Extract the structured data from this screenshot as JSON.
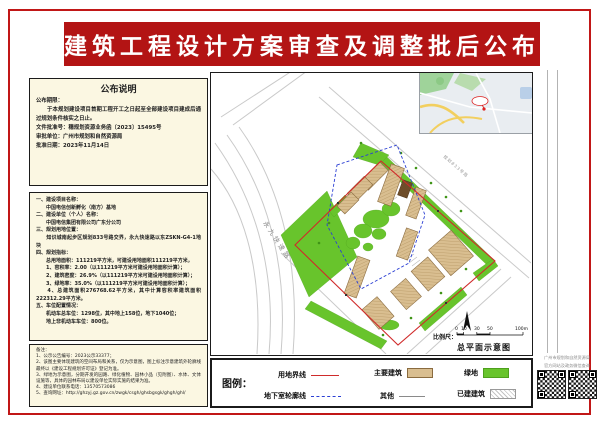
{
  "page": {
    "title": "建筑工程设计方案审查及调整批后公布",
    "colors": {
      "banner_red": "#b31414",
      "frame_red": "#c11717",
      "box_cream": "#fbf7e2",
      "building_tan": "#d9be90",
      "green": "#68c42c",
      "boundary_red": "#cf2b2b",
      "underground_blue": "#2b3fd4",
      "other_gray": "#8a8a8a"
    }
  },
  "announcement": {
    "title": "公布说明",
    "lines": [
      "公布期限：",
      "　　于本规划建设项目首期工程开工之日起至全部建设项目建成后通过规划条件核实之日止。",
      "文件批准号：穗规划资源业务函〔2023〕15495号",
      "审批单位：广州市规划和自然资源局",
      "批准日期：2023年11月14日"
    ]
  },
  "project_info": {
    "lines": [
      "一、建设项目名称：",
      "　　中国电信创新孵化（南方）基地",
      "二、建设单位（个人）名称：",
      "　　中国电信集团有限公司广东分公司",
      "三、规划用地位置：",
      "　　知识城南起步区规划833号路交界，永九快速路以东ZSKN-G4-1地块",
      "四、规划指标：",
      "　　总用地面积：111219平方米，可建设用地面积111219平方米，",
      "　　1、容积率：2.00（以111219平方米可建设用地面积计算）；",
      "　　2、建筑密度：26.9%（以111219平方米可建设用地面积计算）；",
      "　　3、绿地率：35.0%（以111219平方米可建设用地面积计算）；",
      "　　4、总建筑面积276768.62平方米，其中计算容积率建筑面积222312.29平方米。",
      "五、车位配置情况：",
      "　　机动车总车位：1298位，其中地上158位，地下1040位；",
      "　　地上非机动车车位：800位。"
    ]
  },
  "notes": {
    "lines": [
      "备注：",
      "1、公示公告编号：2023公示33377；",
      "2、该图主要体现建筑的空间布局和关系，仅为示意图，图上标注示意建筑外轮廓线最终以《建设工程规划许可证》登记为准。",
      "3、绿地为示意图，分期开发的园路、绿化植物、园林小品（见附图）、水体、文体设施等，具体的园林布局以建设单位实际实施的结果为准。",
      "4、建设单位联系电话：13570573086",
      "5、查询网址：http://ghzyj.gz.gov.cn/zwgk/csgh/ghsbgsgk/ghgh/ghl/"
    ]
  },
  "map": {
    "road_label_west": "永九快速路",
    "road_label_ne": "规划833号路",
    "scale_label": "比例尺：",
    "scale_ticks": [
      "0",
      "10",
      "30",
      "50",
      "100m"
    ],
    "caption": "总平面示意图"
  },
  "legend": {
    "title": "图例：",
    "items": [
      {
        "label": "用地界线",
        "type": "line",
        "color": "#cf2b2b"
      },
      {
        "label": "主要建筑",
        "type": "swatch",
        "color": "#d9be90"
      },
      {
        "label": "绿地",
        "type": "swatch",
        "color": "#68c42c"
      },
      {
        "label": "地下室轮廓线",
        "type": "dashed",
        "color": "#2b3fd4"
      },
      {
        "label": "其他",
        "type": "line",
        "color": "#8a8a8a"
      },
      {
        "label": "已建建筑",
        "type": "hatch",
        "color": "#ffffff"
      }
    ]
  },
  "qr": {
    "caption_line1": "广州市规划和自然资源局",
    "caption_line2": "官方网站及政务微信查询"
  }
}
